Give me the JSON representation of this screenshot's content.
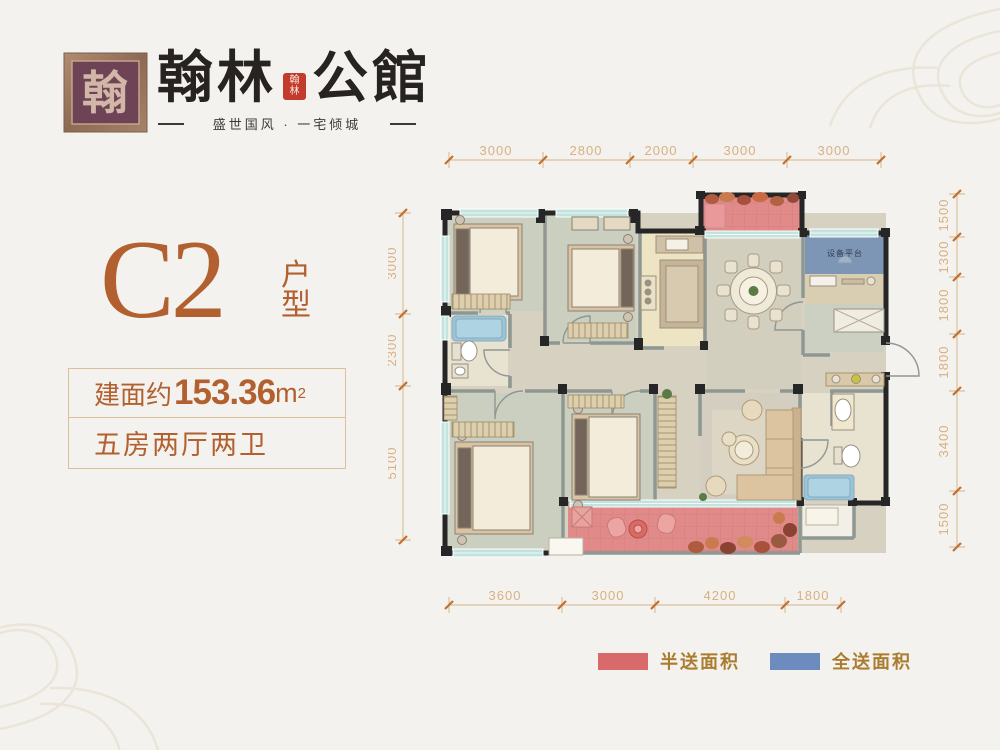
{
  "header": {
    "brand_left": "翰林",
    "brand_right": "公館",
    "seal_glyph": "翰",
    "mini_seal_line1": "翰",
    "mini_seal_line2": "林",
    "tagline": "盛世国风 · 一宅倾城"
  },
  "unit": {
    "code": "C2",
    "type_label": "户型"
  },
  "specs": {
    "area_prefix": "建面约",
    "area_value": "153.36",
    "area_unit": "m",
    "area_sup": "2",
    "layout": "五房两厅两卫"
  },
  "plan": {
    "equipment_label": "设备平台"
  },
  "dimensions": {
    "top": [
      "3000",
      "2800",
      "2000",
      "3000",
      "3000"
    ],
    "bottom": [
      "3600",
      "3000",
      "4200",
      "1800"
    ],
    "left": [
      "3000",
      "2300",
      "5100"
    ],
    "right": [
      "1500",
      "1300",
      "1800",
      "1800",
      "3400",
      "1500"
    ]
  },
  "legend": {
    "items": [
      {
        "label": "半送面积",
        "color": "#d96a6b"
      },
      {
        "label": "全送面积",
        "color": "#6c8cbf"
      }
    ]
  },
  "colors": {
    "background": "#f4f2ee",
    "accent_orange": "#b2602f",
    "brand_black": "#262321",
    "seal_red": "#c23b2c",
    "dim_text": "#d8b083",
    "dim_line": "#dcc09c",
    "dim_tick": "#c1702f",
    "balcony_half_red": "#e18a8a",
    "platform_blue": "#7e96b6",
    "wall_dark": "#262626",
    "wall_gray": "#8e9792",
    "window_teal": "#c2e3dd",
    "legend_text": "#ab7c2f"
  }
}
